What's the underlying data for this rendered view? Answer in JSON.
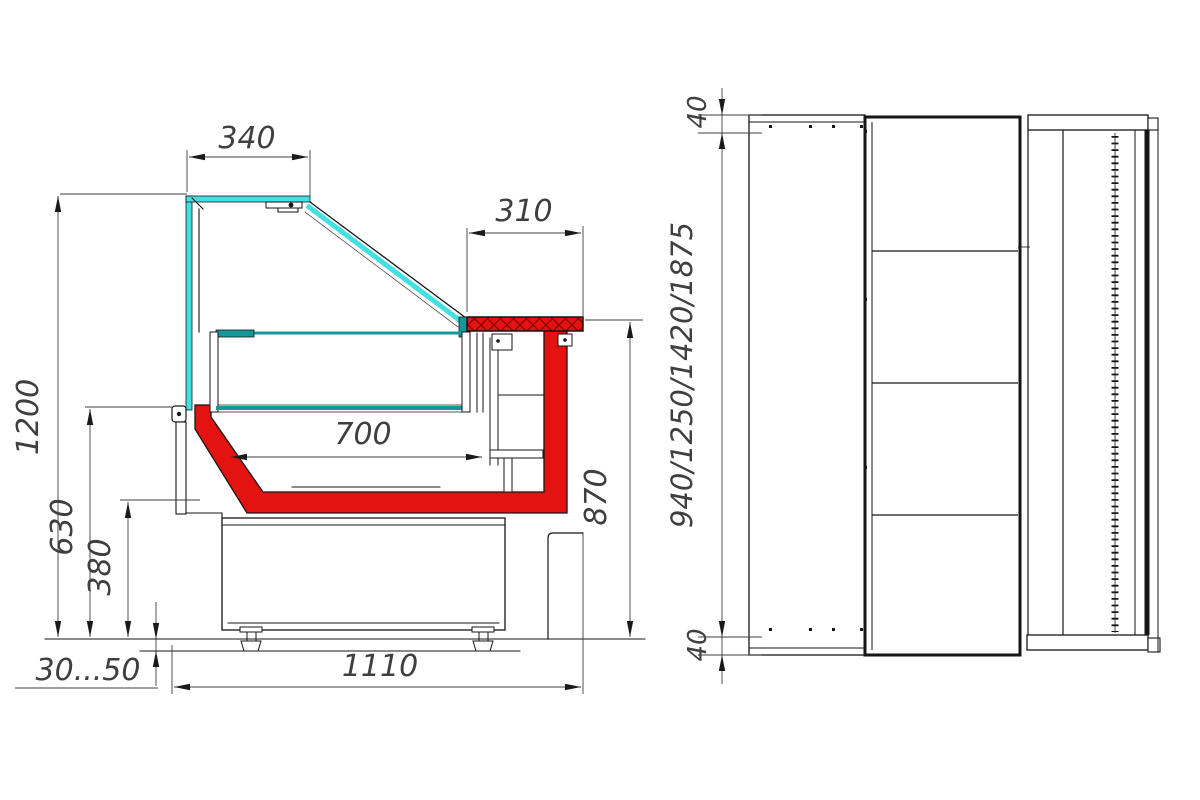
{
  "drawing": {
    "type": "technical-drawing",
    "subject": "refrigerated display showcase — side section and plan view",
    "side": {
      "name": "side-cross-section-view",
      "dims": {
        "top_glass_depth": "340",
        "serve_shelf_depth": "310",
        "bed_depth": "700",
        "overall_height": "1200",
        "bed_height": "630",
        "base_height": "380",
        "feet_range": "30...50",
        "overall_depth": "1110",
        "counter_height": "870"
      }
    },
    "plan": {
      "name": "plan-view",
      "dims": {
        "edge_top": "40",
        "length_variants": "940/1250/1420/1875",
        "edge_bottom": "40"
      }
    },
    "colors": {
      "glass_cyan": "#42e0e2",
      "body_red": "#e31311",
      "hatch_red": "#8e0000",
      "bed_teal": "#16989a",
      "object_line": "#1a1a1a",
      "dim_line": "#3f3f3f",
      "background": "#ffffff"
    }
  }
}
